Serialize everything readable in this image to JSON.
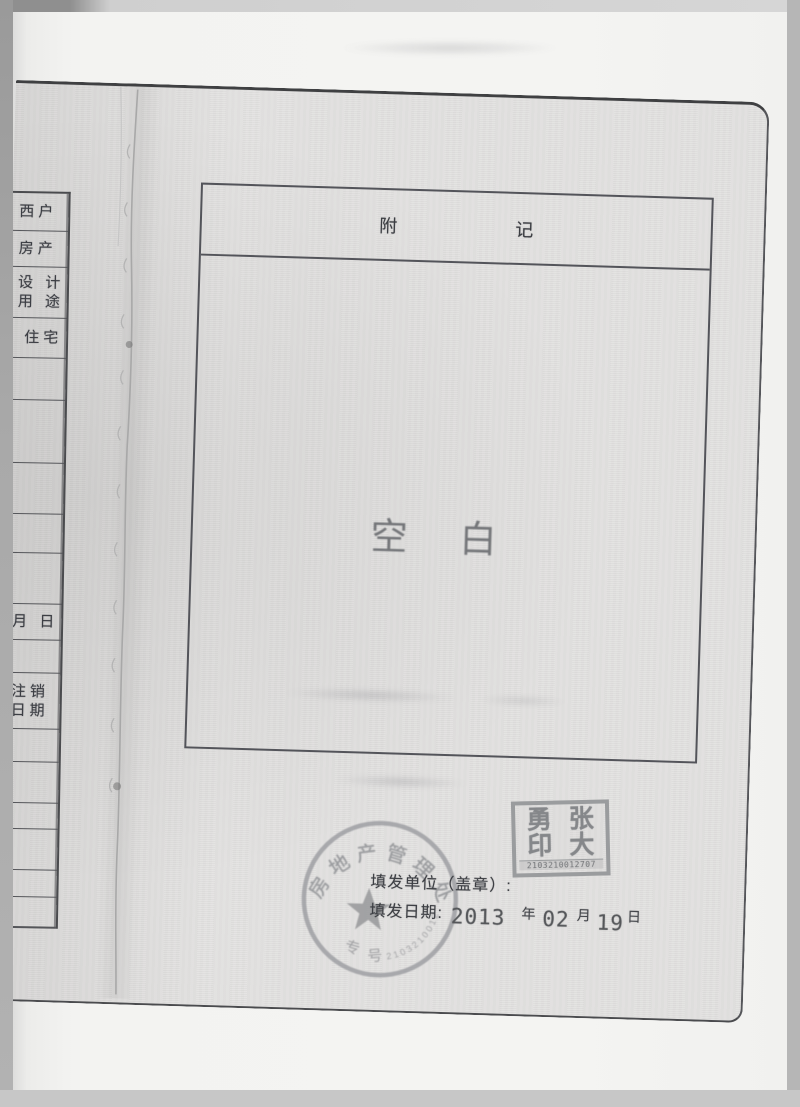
{
  "document": {
    "annex_box": {
      "title_char1": "附",
      "title_char2": "记"
    },
    "blank_stamp": {
      "char1": "空",
      "char2": "白"
    },
    "issue": {
      "unit_label": "填发单位（盖章）:",
      "date_label": "填发日期:",
      "year": "2013",
      "year_unit": "年",
      "month": "02",
      "month_unit": "月",
      "day": "19",
      "day_unit": "日"
    },
    "round_stamp": {
      "arc_text": "房地产管理处",
      "bottom_char1": "专",
      "bottom_char2": "号",
      "serial": "2103210012707"
    },
    "name_seal": {
      "char_tl": "勇",
      "char_tr": "张",
      "char_bl": "印",
      "char_br": "大",
      "serial": "2103210012707"
    }
  },
  "left_page": {
    "rows": [
      {
        "label": "西户"
      },
      {
        "label": "房产"
      },
      {
        "label": "设 计",
        "label2": "用 途"
      },
      {
        "label": "住宅"
      },
      {
        "label": ""
      },
      {
        "label": ""
      },
      {
        "label": ""
      },
      {
        "label": ""
      },
      {
        "label": ""
      },
      {
        "label": "月  日"
      },
      {
        "label": ""
      },
      {
        "label": "注销",
        "label2": "日期"
      },
      {
        "label": ""
      },
      {
        "label": ""
      },
      {
        "label": ""
      },
      {
        "label": ""
      },
      {
        "label": ""
      },
      {
        "label": ""
      }
    ]
  }
}
